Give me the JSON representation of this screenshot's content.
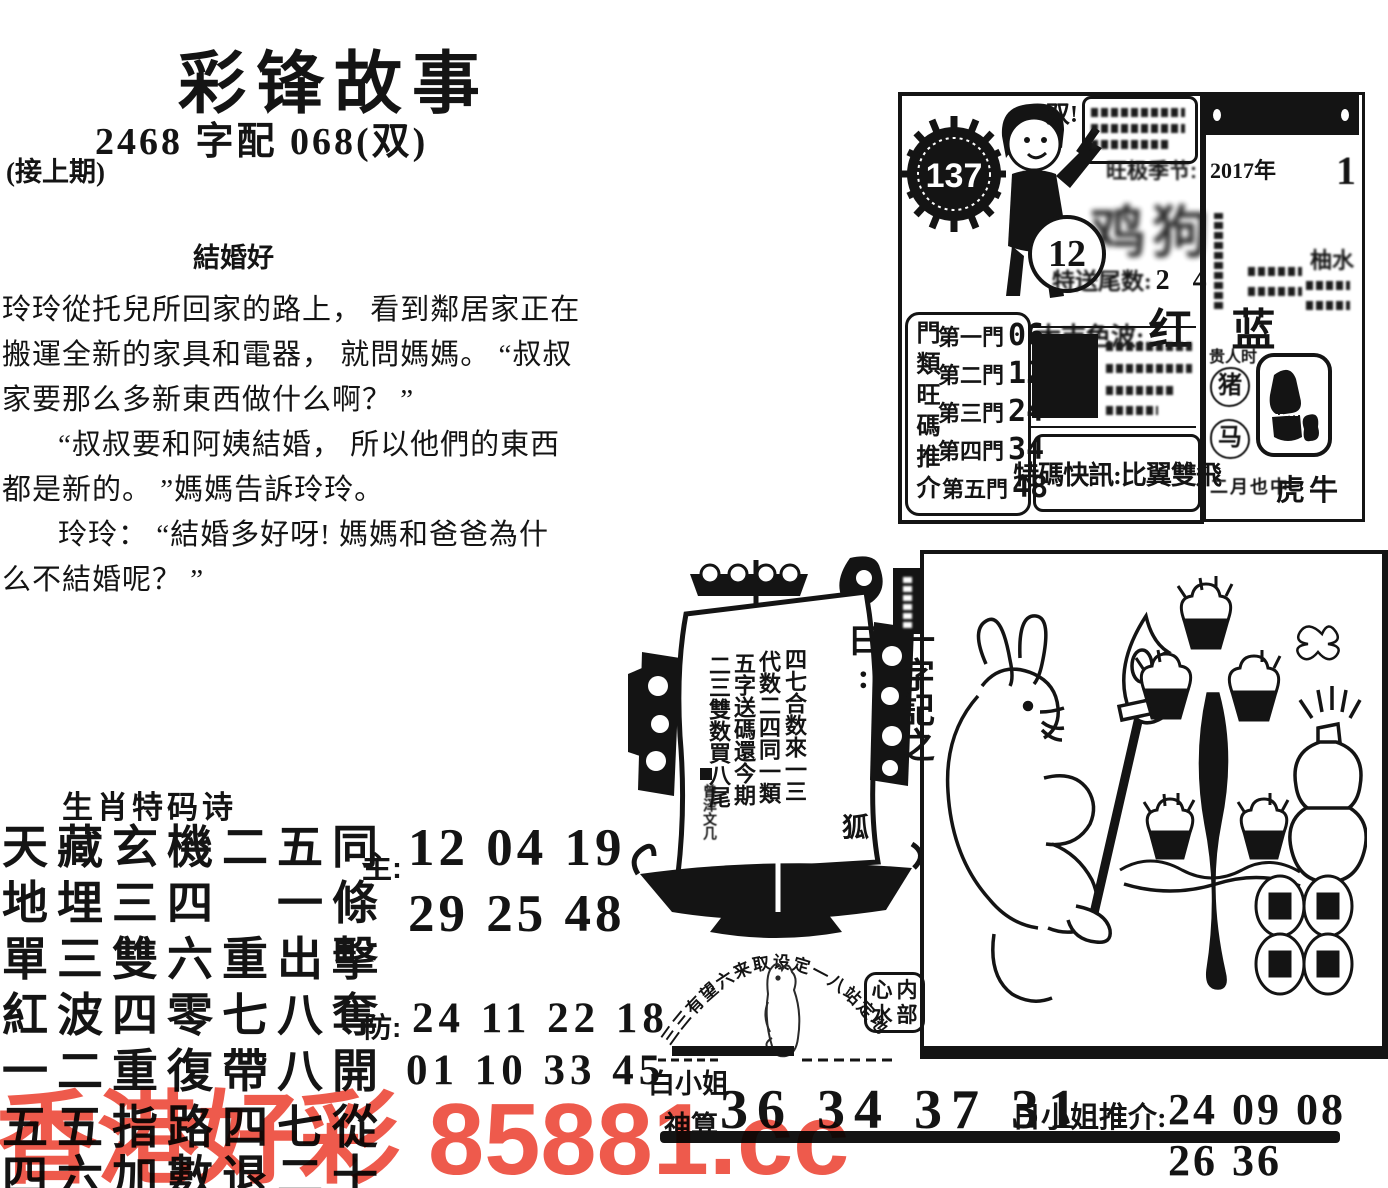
{
  "masthead": {
    "title": "彩锋故事",
    "pairing": "2468 字配 068(双)",
    "continued": "(接上期)"
  },
  "story": {
    "title": "結婚好",
    "lines": [
      "玲玲從托兒所回家的路上， 看到鄰居家正在",
      "搬運全新的家具和電器， 就問媽媽。 “叔叔",
      "家要那么多新東西做什么啊？ ”",
      "“叔叔要和阿姨結婚， 所以他們的東西",
      "都是新的。 ”媽媽告訴玲玲。",
      "玲玲： “結婚多好呀! 媽媽和爸爸為什",
      "么不結婚呢？ ”"
    ]
  },
  "poem": {
    "heading": "生肖特码诗",
    "lines": [
      "天藏玄機二五同",
      "地埋三四　一條",
      "單三雙六重出擊",
      "紅波四零七八奪",
      "一二重復帶八開",
      "五五指路四七從",
      "四六加數退二十"
    ],
    "main_label": "主:",
    "main_rows": [
      "12 04 19",
      "29 25 48"
    ],
    "guard_label": "防:",
    "guard_rows": [
      "24 11 22 18",
      "01 10 33 45"
    ]
  },
  "issue_box": {
    "issue_number": "137",
    "ball_number": "12",
    "shout": "双!",
    "season_label": "旺极季节:",
    "season_value": "鸡狗",
    "tail_label": "特送尾数:",
    "tail_value": "2 4",
    "wave_label": "大吉色波:",
    "wave_value": "红 蓝",
    "gate_title": "門類旺碼推介",
    "gates": [
      {
        "label": "第一門",
        "value": "06"
      },
      {
        "label": "第二門",
        "value": "12"
      },
      {
        "label": "第三門",
        "value": "24"
      },
      {
        "label": "第四門",
        "value": "34"
      },
      {
        "label": "第五門",
        "value": "48"
      }
    ],
    "flash": "特碼快訊:比翼雙飛"
  },
  "calendar": {
    "year": "2017年",
    "day": "1",
    "right_note": "柚水",
    "time_note": "贵人时",
    "zodiac_circles": [
      "猪",
      "马"
    ],
    "bottom_small": "二月也中",
    "bottom_zodiac": "虎牛"
  },
  "ship": {
    "scroll_title": "一字記之曰:",
    "scroll_answer": "狐",
    "verse_columns": [
      "四七合数來一三",
      "代数二四同一類",
      "五字送碼還今期",
      "二三雙数買八尾"
    ],
    "signature": "曾泽文几"
  },
  "seal_area": {
    "arc_text": "三三有望六来取设定一八站定地",
    "stamp_chars": [
      "心",
      "内",
      "水",
      "部"
    ]
  },
  "bottom_strip": {
    "name_top": "白小姐",
    "name_bottom": "神算",
    "numbers_left": "36 34 37 31",
    "recommend_label": "日小姐推介:",
    "recommend_numbers": "24 09 08 26 36"
  },
  "watermark": {
    "text": "香港好彩 85881.cc",
    "color": "#ee5a4c"
  }
}
